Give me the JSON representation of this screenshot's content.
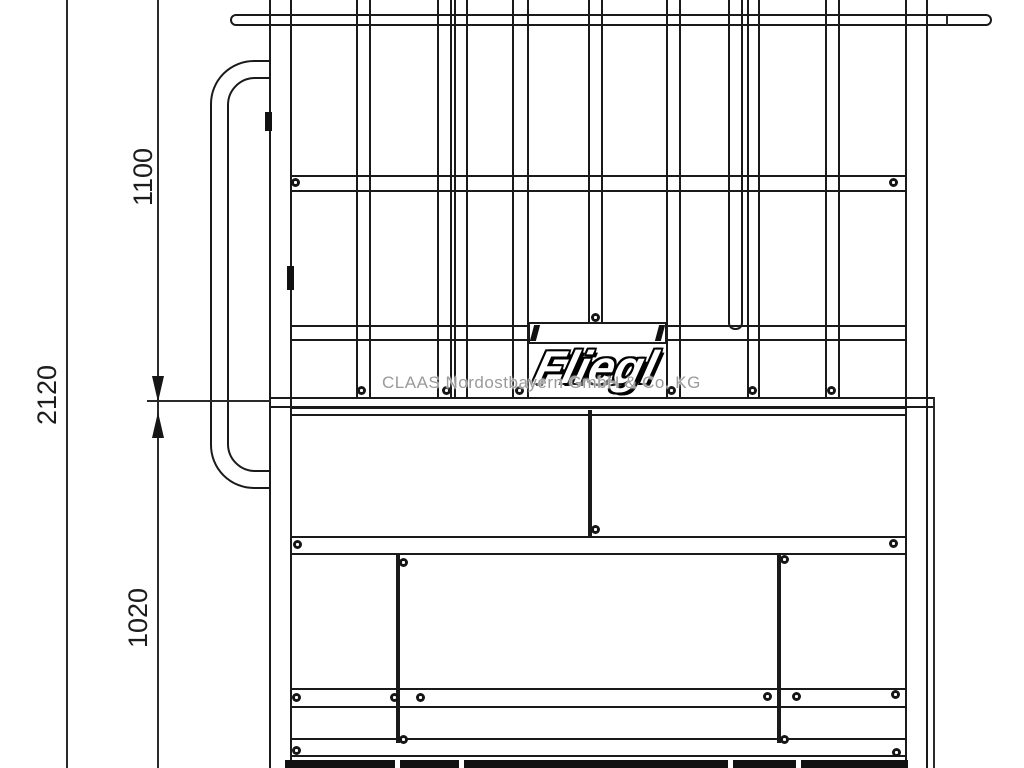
{
  "drawing": {
    "brand": "Fliegl",
    "watermark": "CLAAS Nordostbayern GmbH & Co. KG",
    "dimensions": {
      "overall": "2120",
      "upper": "1100",
      "lower": "1020"
    },
    "colors": {
      "line": "#1a1a1a",
      "background": "#ffffff",
      "watermark_text": "#9a9a9a",
      "logo_fill": "#ffffff",
      "logo_outline": "#000000"
    }
  }
}
